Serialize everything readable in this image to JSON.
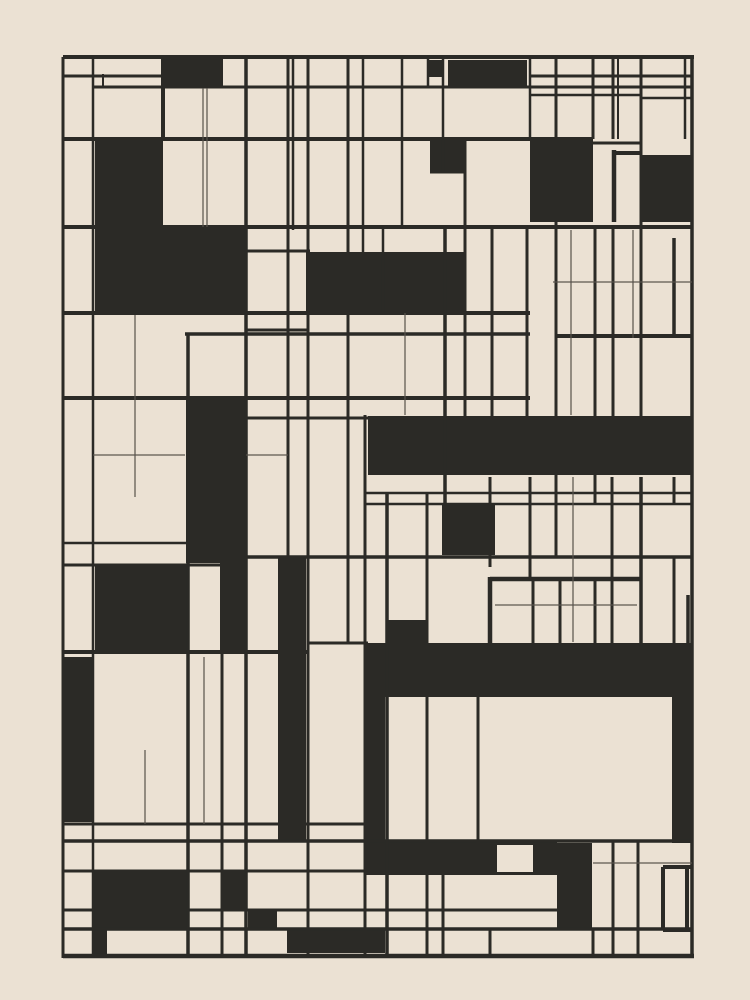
{
  "artwork": {
    "description": "abstract-geometric-grid-composition",
    "canvas": {
      "width": 750,
      "height": 1000,
      "background": "#ebe1d3",
      "ink": "#2b2a26",
      "thin_ink": "#57524a"
    },
    "black_rects": [
      [
        163,
        57,
        60,
        30
      ],
      [
        428,
        60,
        15,
        17
      ],
      [
        448,
        60,
        79,
        27
      ],
      [
        95,
        140,
        68,
        173
      ],
      [
        163,
        228,
        84,
        85
      ],
      [
        530,
        139,
        63,
        83
      ],
      [
        640,
        155,
        52,
        67
      ],
      [
        306,
        252,
        159,
        61
      ],
      [
        186,
        400,
        61,
        163
      ],
      [
        220,
        563,
        27,
        89
      ],
      [
        95,
        565,
        92,
        87
      ],
      [
        278,
        557,
        28,
        285
      ],
      [
        368,
        416,
        324,
        59
      ],
      [
        430,
        139,
        35,
        33
      ],
      [
        442,
        505,
        53,
        50
      ],
      [
        367,
        643,
        325,
        54
      ],
      [
        387,
        620,
        41,
        23
      ],
      [
        365,
        643,
        20,
        232
      ],
      [
        63,
        657,
        30,
        165
      ],
      [
        365,
        841,
        192,
        34
      ],
      [
        557,
        843,
        35,
        86
      ],
      [
        672,
        697,
        20,
        146
      ],
      [
        93,
        872,
        94,
        56
      ],
      [
        93,
        928,
        14,
        27
      ],
      [
        223,
        872,
        24,
        38
      ],
      [
        248,
        910,
        29,
        19
      ],
      [
        287,
        929,
        98,
        24
      ]
    ],
    "cream_rects": [
      [
        497,
        845,
        36,
        27
      ]
    ],
    "h_lines": [
      [
        57,
        63,
        694,
        4
      ],
      [
        76,
        63,
        163,
        3
      ],
      [
        76,
        530,
        692,
        3
      ],
      [
        87,
        93,
        692,
        3
      ],
      [
        95,
        530,
        641,
        2.5
      ],
      [
        98,
        641,
        692,
        2.5
      ],
      [
        139,
        63,
        593,
        4
      ],
      [
        143,
        593,
        641,
        3
      ],
      [
        153,
        614,
        641,
        4
      ],
      [
        172,
        430,
        465,
        3
      ],
      [
        227,
        63,
        692,
        4
      ],
      [
        251,
        246,
        310,
        3
      ],
      [
        313,
        63,
        530,
        4
      ],
      [
        330,
        246,
        308,
        3
      ],
      [
        334,
        185,
        530,
        3.5
      ],
      [
        336,
        557,
        692,
        4
      ],
      [
        398,
        63,
        530,
        4
      ],
      [
        418,
        246,
        370,
        3
      ],
      [
        493,
        365,
        692,
        2.5
      ],
      [
        504,
        365,
        692,
        2.5
      ],
      [
        543,
        63,
        188,
        2.5
      ],
      [
        557,
        246,
        692,
        3.5
      ],
      [
        565,
        63,
        246,
        3
      ],
      [
        579,
        490,
        640,
        4.5
      ],
      [
        643,
        308,
        368,
        3
      ],
      [
        652,
        63,
        308,
        4
      ],
      [
        824,
        63,
        365,
        3
      ],
      [
        841,
        63,
        692,
        3.5
      ],
      [
        867,
        663,
        692,
        4
      ],
      [
        871,
        63,
        497,
        3
      ],
      [
        910,
        63,
        557,
        3
      ],
      [
        929,
        63,
        692,
        3.5
      ],
      [
        930,
        663,
        692,
        4
      ],
      [
        956,
        63,
        694,
        4.5
      ]
    ],
    "v_lines": [
      [
        63,
        57,
        958,
        3
      ],
      [
        93,
        57,
        958,
        2.5
      ],
      [
        103,
        74,
        88,
        2
      ],
      [
        163,
        57,
        140,
        4
      ],
      [
        188,
        333,
        955,
        3.5
      ],
      [
        222,
        652,
        955,
        3
      ],
      [
        246,
        57,
        955,
        3.5
      ],
      [
        288,
        57,
        557,
        3
      ],
      [
        293,
        57,
        230,
        2.5
      ],
      [
        308,
        57,
        955,
        3
      ],
      [
        348,
        57,
        643,
        3
      ],
      [
        363,
        57,
        252,
        2.5
      ],
      [
        365,
        415,
        955,
        3
      ],
      [
        383,
        227,
        313,
        2.5
      ],
      [
        387,
        493,
        955,
        3.5
      ],
      [
        402,
        57,
        227,
        2.5
      ],
      [
        427,
        493,
        955,
        3
      ],
      [
        428,
        57,
        88,
        2.5
      ],
      [
        443,
        57,
        172,
        2.5
      ],
      [
        443,
        841,
        955,
        3
      ],
      [
        445,
        227,
        505,
        3.5
      ],
      [
        465,
        139,
        418,
        3
      ],
      [
        478,
        697,
        843,
        3
      ],
      [
        490,
        477,
        567,
        3
      ],
      [
        490,
        577,
        647,
        4.5
      ],
      [
        490,
        929,
        955,
        3
      ],
      [
        492,
        227,
        418,
        3
      ],
      [
        527,
        227,
        418,
        3
      ],
      [
        530,
        57,
        139,
        2.5
      ],
      [
        530,
        477,
        577,
        3
      ],
      [
        533,
        577,
        647,
        3
      ],
      [
        556,
        57,
        557,
        3
      ],
      [
        560,
        577,
        647,
        3
      ],
      [
        593,
        57,
        139,
        3
      ],
      [
        595,
        227,
        505,
        3
      ],
      [
        595,
        577,
        647,
        3
      ],
      [
        593,
        929,
        955,
        3
      ],
      [
        613,
        57,
        139,
        3
      ],
      [
        618,
        57,
        139,
        2
      ],
      [
        614,
        150,
        222,
        4.5
      ],
      [
        613,
        227,
        418,
        3
      ],
      [
        612,
        477,
        647,
        3
      ],
      [
        613,
        841,
        955,
        3
      ],
      [
        641,
        57,
        418,
        3
      ],
      [
        641,
        477,
        647,
        3.5
      ],
      [
        638,
        841,
        955,
        3
      ],
      [
        663,
        867,
        930,
        4
      ],
      [
        687,
        867,
        930,
        4
      ],
      [
        674,
        238,
        338,
        3.5
      ],
      [
        674,
        477,
        505,
        3
      ],
      [
        674,
        557,
        647,
        3
      ],
      [
        688,
        595,
        647,
        3.5
      ],
      [
        692,
        57,
        958,
        3.5
      ],
      [
        685,
        57,
        139,
        2.5
      ]
    ],
    "thin_h_lines": [
      [
        282,
        553,
        692,
        1.2
      ],
      [
        455,
        93,
        185,
        1.2
      ],
      [
        455,
        246,
        288,
        1.2
      ],
      [
        605,
        495,
        637,
        1.2
      ],
      [
        863,
        593,
        692,
        1.2
      ]
    ],
    "thin_v_lines": [
      [
        203,
        88,
        227,
        1.2
      ],
      [
        207,
        88,
        227,
        1.2
      ],
      [
        135,
        315,
        497,
        1.2
      ],
      [
        405,
        313,
        415,
        1.2
      ],
      [
        571,
        230,
        415,
        1.2
      ],
      [
        573,
        477,
        642,
        1.2
      ],
      [
        633,
        230,
        338,
        1.2
      ],
      [
        145,
        750,
        824,
        1.2
      ],
      [
        204,
        657,
        824,
        1.2
      ]
    ]
  }
}
